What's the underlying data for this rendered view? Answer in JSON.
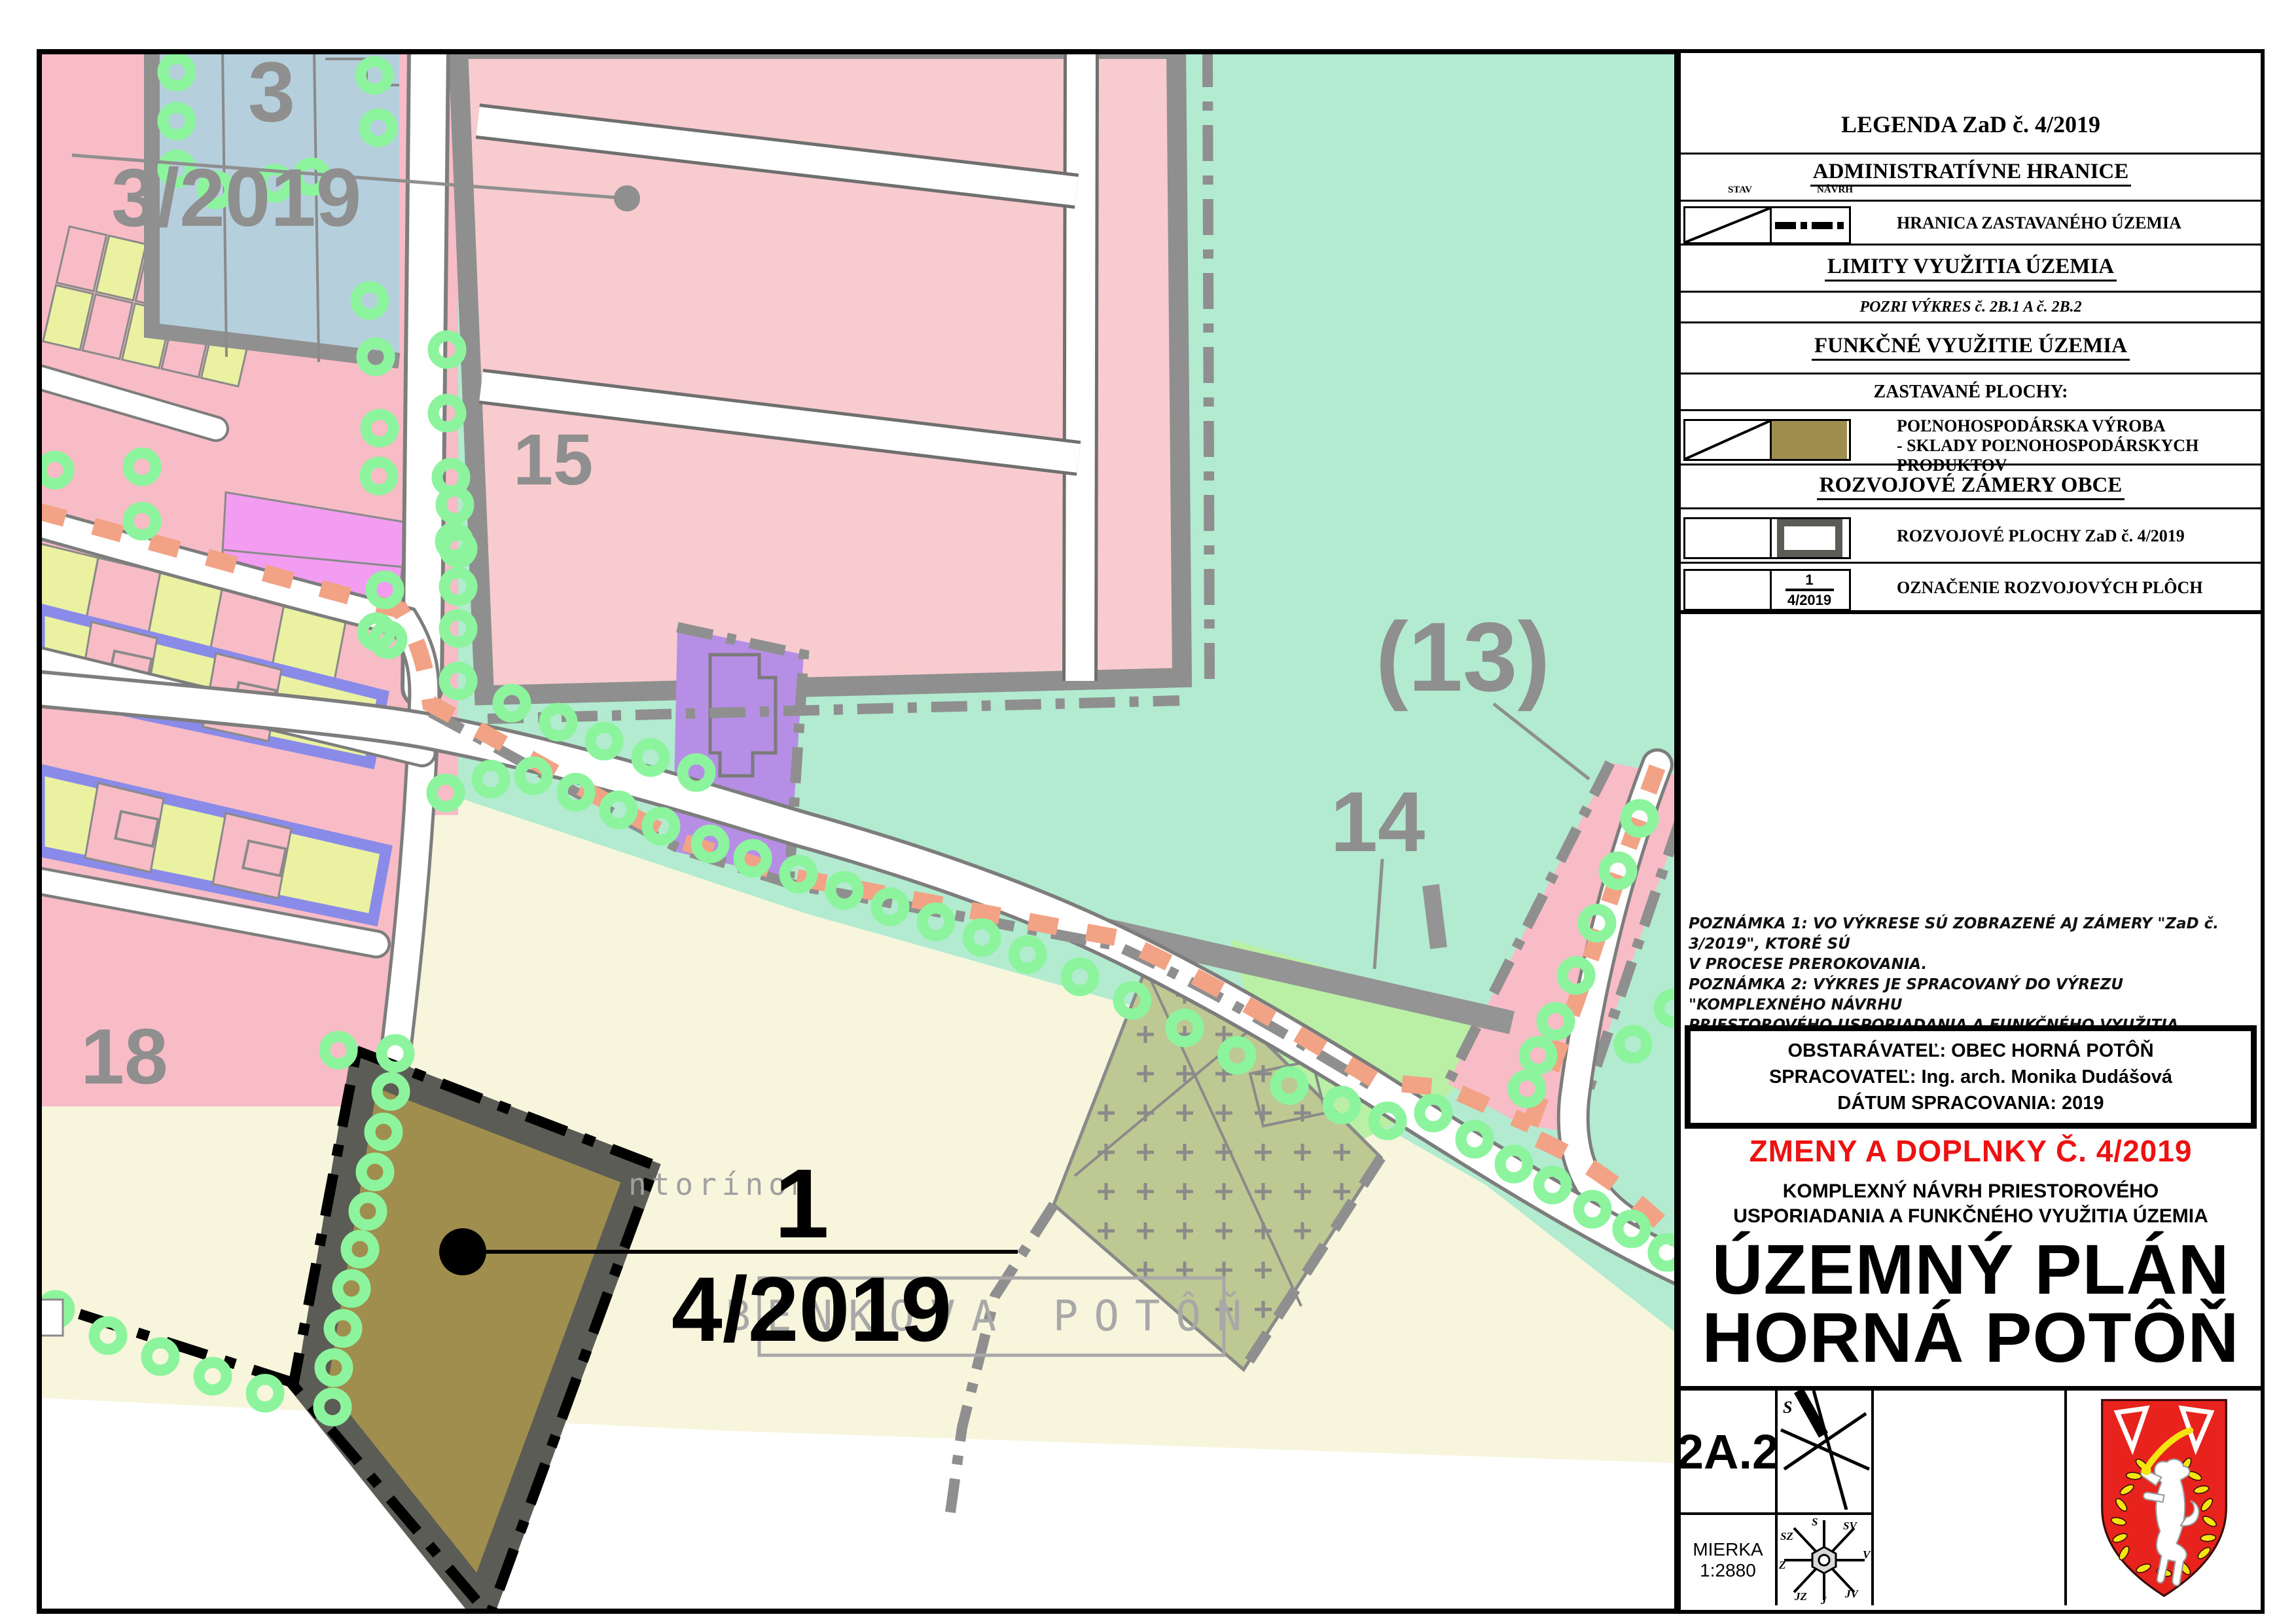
{
  "map": {
    "labels": {
      "zone3": "3",
      "zone3_ref": "3/2019",
      "zone15": "15",
      "zone13": "(13)",
      "zone14": "14",
      "zone18": "18",
      "dev_no": "1",
      "dev_ref": "4/2019",
      "settlement": "BENKOVA POTÔŇ",
      "cemetery_partial": "ntorínom"
    }
  },
  "legend": {
    "title": "LEGENDA ZaD č. 4/2019",
    "admin_header": "ADMINISTRATÍVNE HRANICE",
    "col_stav": "STAV",
    "col_navrh": "NÁVRH",
    "hranica": "HRANICA ZASTAVANÉHO ÚZEMIA",
    "limity_header": "LIMITY VYUŽITIA ÚZEMIA",
    "pozri": "POZRI VÝKRES č. 2B.1 A č. 2B.2",
    "funkcne_header": "FUNKČNÉ VYUŽITIE ÚZEMIA",
    "zastavane": "ZASTAVANÉ PLOCHY:",
    "polno1": "POĽNOHOSPODÁRSKA VÝROBA",
    "polno2": "- SKLADY POĽNOHOSPODÁRSKYCH PRODUKTOV",
    "rozvoj_header": "ROZVOJOVÉ ZÁMERY OBCE",
    "rozvoj_plochy": "ROZVOJOVÉ PLOCHY ZaD č. 4/2019",
    "oznacenie": "OZNAČENIE ROZVOJOVÝCH PLÔCH",
    "frac_top": "1",
    "frac_bottom": "4/2019"
  },
  "notes": {
    "l1": "POZNÁMKA 1: VO VÝKRESE SÚ ZOBRAZENÉ AJ ZÁMERY \"ZaD č. 3/2019\", KTORÉ SÚ",
    "l2": "V PROCESE PREROKOVANIA.",
    "l3": "POZNÁMKA 2: VÝKRES  JE SPRACOVANÝ DO VÝREZU  \"KOMPLEXNÉHO NÁVRHU",
    "l4": "PRIESTOROVÉHO  USPORIADANIA  A  FUNKČNÉHO  VYUŽITIA  ÚZEMIA\"   PLATNÉHO",
    "l5": "ÚPN OBCE HORNÁ POTÔŇ."
  },
  "publisher": {
    "l1": "OBSTARÁVATEĽ: OBEC  HORNÁ  POTÔŇ",
    "l2": "SPRACOVATEĽ: Ing. arch. Monika Dudášová",
    "l3": "DÁTUM SPRACOVANIA: 2019"
  },
  "titleblock": {
    "red": "ZMENY A DOPLNKY Č. 4/2019",
    "sub1": "KOMPLEXNÝ  NÁVRH  PRIESTOROVÉHO",
    "sub2": "USPORIADANIA  A  FUNKČNÉHO  VYUŽITIA  ÚZEMIA",
    "main1": "ÚZEMNÝ PLÁN",
    "main2": "HORNÁ POTÔŇ"
  },
  "sheetblock": {
    "sheet": "2A.2",
    "scale_label": "MIERKA",
    "scale": "1:2880",
    "compass": {
      "n": "S",
      "ne": "SV",
      "e": "V",
      "se": "JV",
      "s": "J",
      "sw": "JZ",
      "w": "Z",
      "nw": "SZ"
    }
  },
  "colors": {
    "teal": "#b2ebcf",
    "cream": "#f8f5dd",
    "pink_urban": "#f8bcc6",
    "pink_farm": "#f8cbcf",
    "blue_zone": "#b6cfdd",
    "light_green": "#b9f0a5",
    "cemetery": "#bec893",
    "khaki": "#a08e4e",
    "khaki_border": "#5c5c57",
    "purple": "#b78ee6",
    "magenta": "#f29df2",
    "periwinkle": "#8a8ae8",
    "parcel_yellow": "#eaf2a2",
    "orange_dash": "#f2a285",
    "green_donut": "#8df49e",
    "gray_line": "#8f8f8f",
    "ghost_gray": "#a0a0a0",
    "title_red": "#ee1111",
    "arms_red": "#e8231d",
    "arms_yellow": "#f5e410"
  }
}
